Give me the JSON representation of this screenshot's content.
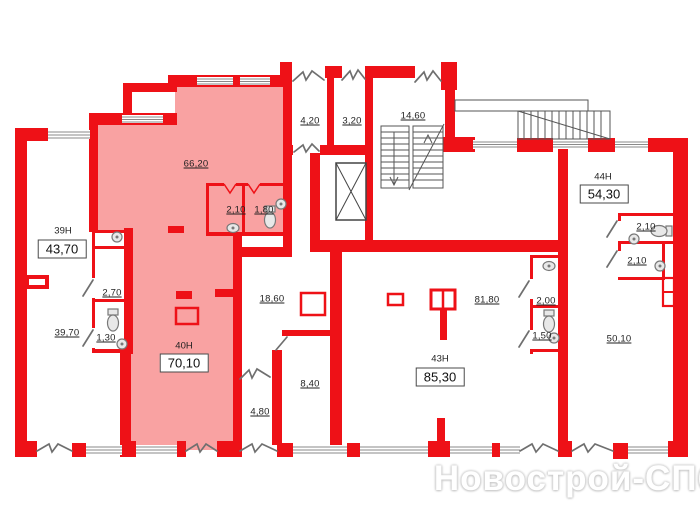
{
  "plan": {
    "watermark": "Новострой-СПб",
    "colors": {
      "wall": "#ee1117",
      "highlight": "#f9a2a2",
      "door": "#6f6f6f",
      "window_line": "#8a8a8a",
      "stair_line": "#555555",
      "label": "#1f1f1f"
    },
    "units": [
      {
        "code": "39Н",
        "area": "43,70",
        "rooms": {
          "main": "39,70",
          "wc1": "2,70",
          "wc2": "1,30"
        }
      },
      {
        "code": "40Н",
        "area": "70,10",
        "rooms": {
          "main": "66,20",
          "wc1": "2,10",
          "wc2": "1,80"
        }
      },
      {
        "code": "43Н",
        "area": "85,30",
        "rooms": {
          "main": "81,80"
        }
      },
      {
        "code": "44Н",
        "area": "54,30",
        "rooms": {
          "main": "50,10",
          "wc1": "2,00",
          "wc2": "1,50",
          "san1": "2,10",
          "san2": "2,10"
        }
      }
    ],
    "common": {
      "room1": "4,20",
      "room2": "3,20",
      "stairwell": "14,60",
      "corridor": "18,60",
      "room3": "8,40",
      "room4": "4,80"
    }
  }
}
